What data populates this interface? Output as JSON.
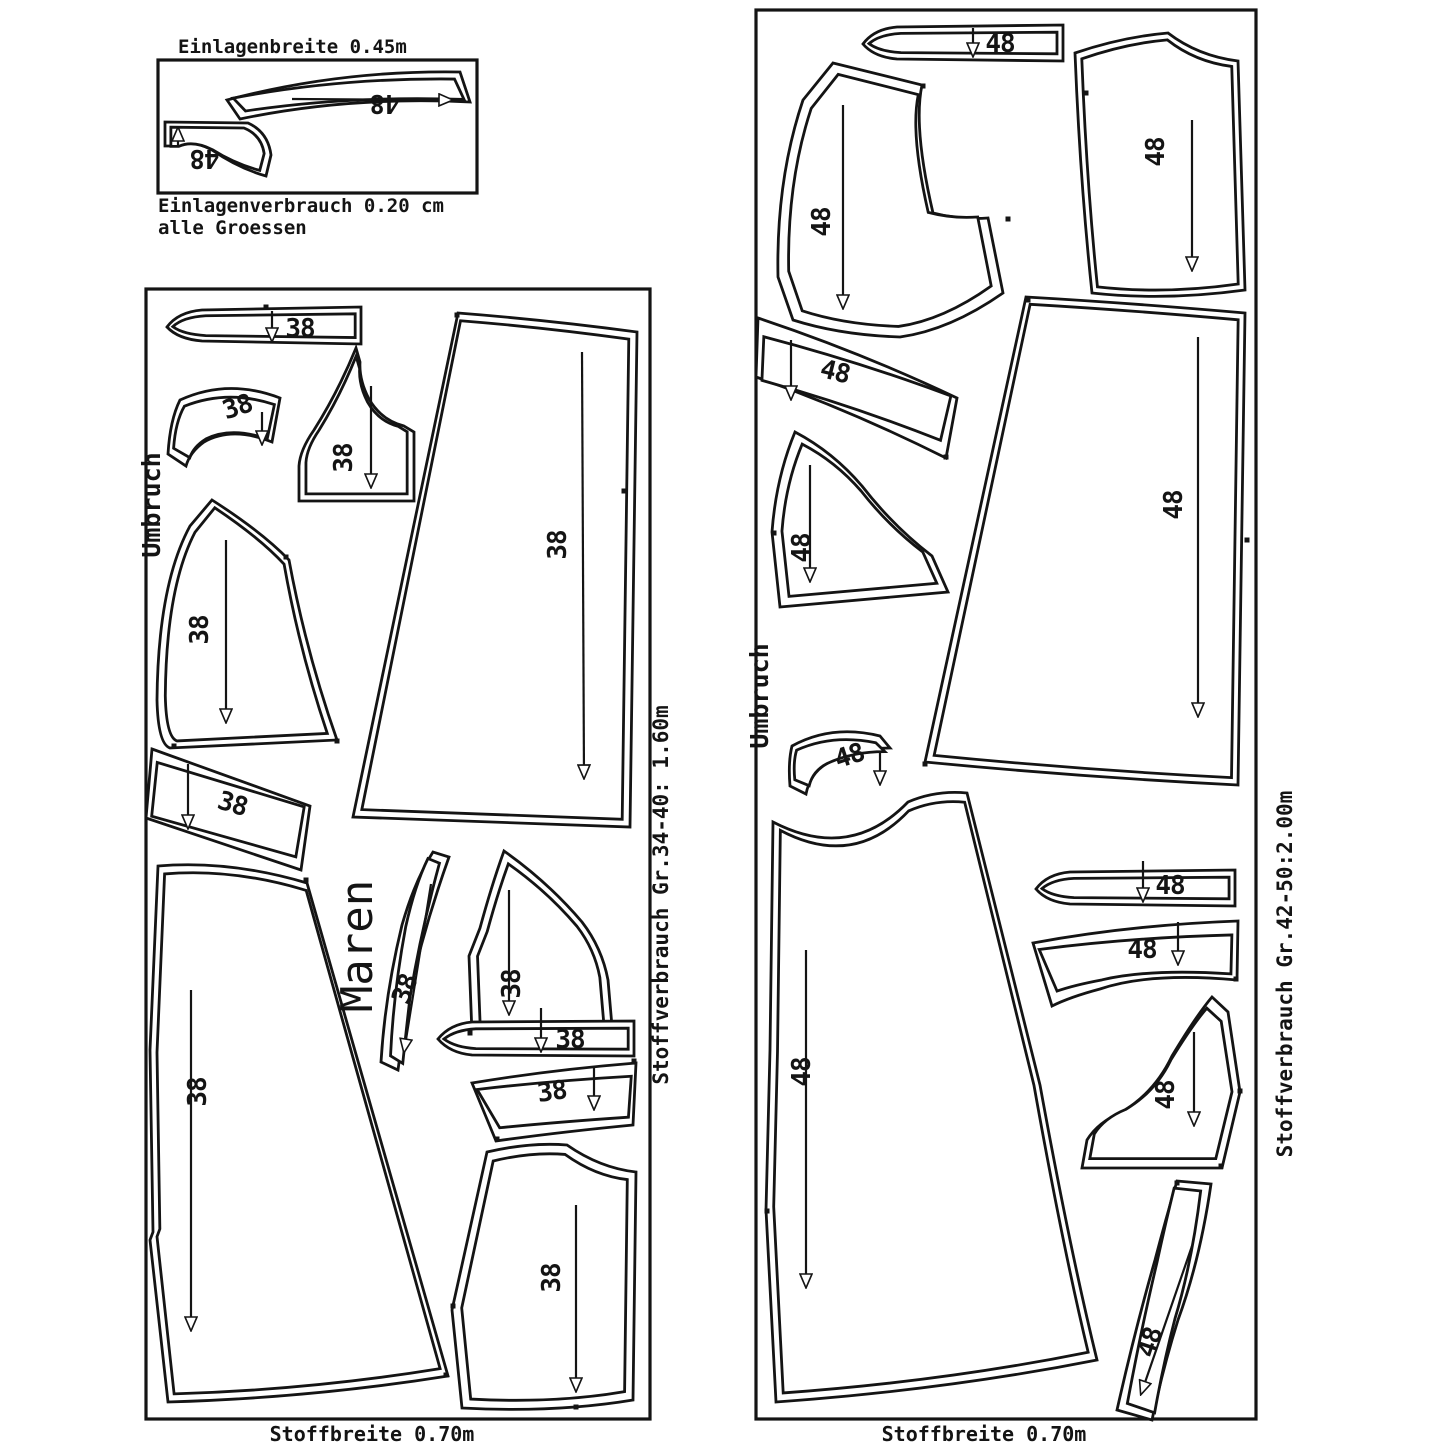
{
  "sheet": {
    "inset": {
      "title": "Einlagenbreite 0.45m",
      "usage_line1": "Einlagenverbrauch 0.20 cm",
      "usage_line2": "alle Groessen",
      "size_label": "48"
    },
    "left_layout": {
      "size_label": "38",
      "fold_label": "Umbruch",
      "model_name": "Maren",
      "fabric_width": "Stoffbreite 0.70m",
      "fabric_usage": "Stoffverbrauch Gr.34-40: 1.60m"
    },
    "right_layout": {
      "size_label": "48",
      "fold_label": "Umbruch",
      "fabric_width": "Stoffbreite 0.70m",
      "fabric_usage": "Stoffverbrauch Gr.42-50:2.00m"
    },
    "line_color": "#141414"
  }
}
